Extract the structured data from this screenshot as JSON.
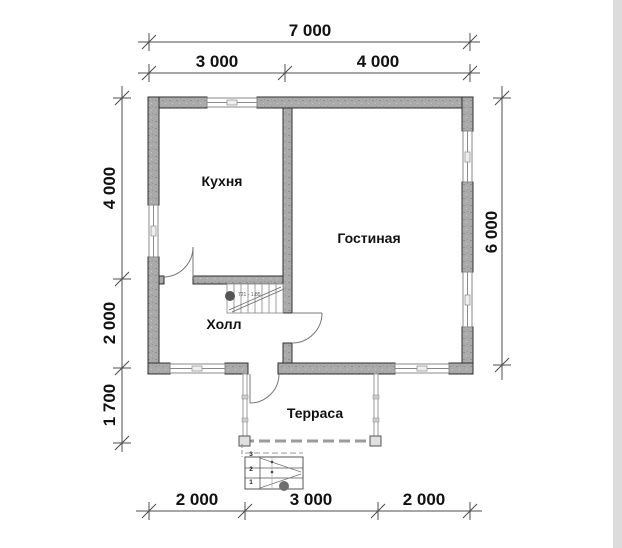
{
  "rooms": {
    "kitchen": "Кухня",
    "living": "Гостиная",
    "hall": "Холл",
    "terrace": "Терраса"
  },
  "dims": {
    "top_total": "7 000",
    "top_kitchen": "3 000",
    "top_living": "4 000",
    "left_upper": "4 000",
    "left_mid": "2 000",
    "left_lower": "1 700",
    "right_total": "6 000",
    "bottom_left": "2 000",
    "bottom_mid": "3 000",
    "bottom_right": "2 000"
  },
  "stairs": {
    "annotation": "721 - 1.85",
    "steps": [
      "1",
      "2",
      "3"
    ]
  },
  "colors": {
    "wall_fill": "#aaaaaa",
    "wall_edge": "#2f2f2f",
    "dim_line": "#4d4d4d",
    "text": "#111111",
    "rail": "#9a9a9a",
    "background": "#ffffff"
  }
}
